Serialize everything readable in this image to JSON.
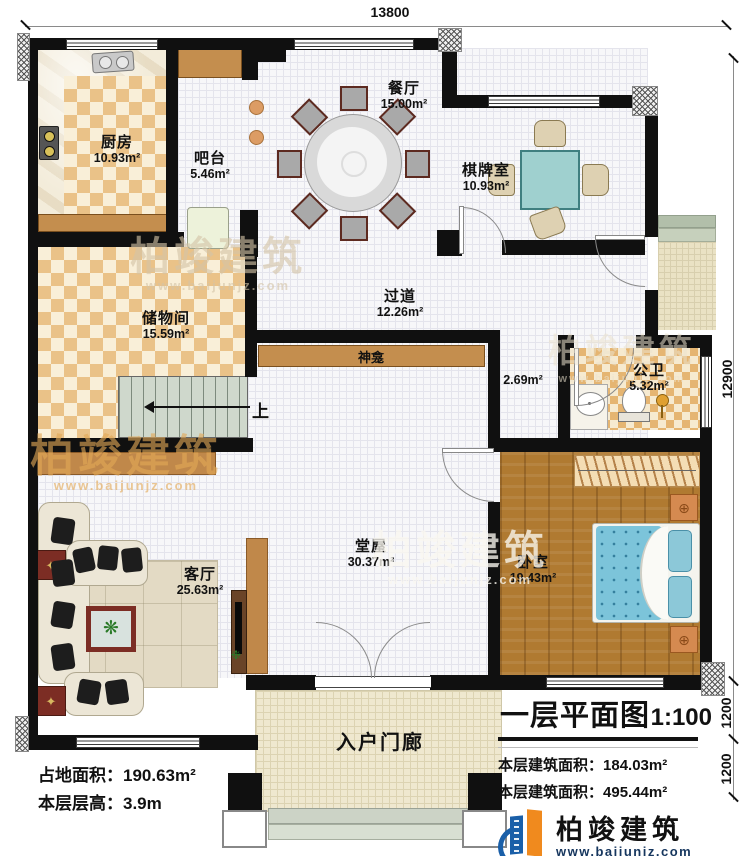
{
  "dimensions": {
    "top": "13800",
    "right_main": "12900",
    "right_upper": "1200",
    "right_lower": "1200"
  },
  "rooms": {
    "kitchen": {
      "name": "厨房",
      "area": "10.93m²"
    },
    "bar": {
      "name": "吧台",
      "area": "5.46m²"
    },
    "dining": {
      "name": "餐厅",
      "area": "15.00m²"
    },
    "chess": {
      "name": "棋牌室",
      "area": "10.93m²"
    },
    "storage": {
      "name": "储物间",
      "area": "15.59m²"
    },
    "corridor": {
      "name": "过道",
      "area": "12.26m²"
    },
    "shrine": {
      "name": "神龛",
      "area": "2.69m²"
    },
    "bathroom": {
      "name": "公卫",
      "area": "5.32m²"
    },
    "hall": {
      "name": "堂屋",
      "area": "30.37m²"
    },
    "living": {
      "name": "客厅",
      "area": "25.63m²"
    },
    "bedroom": {
      "name": "卧室",
      "area": "19.43m²"
    },
    "porch": {
      "name": "入户门廊"
    }
  },
  "stairs": {
    "up_label": "上"
  },
  "info_left": {
    "line1_label": "占地面积：",
    "line1_value": "190.63m²",
    "line2_label": "本层层高：",
    "line2_value": "3.9m"
  },
  "title_block": {
    "title": "一层平面图",
    "scale": "1:100",
    "area1_label": "本层建筑面积：",
    "area1_value": "184.03m²",
    "area2_label": "本层建筑面积：",
    "area2_value": "495.44m²"
  },
  "brand": {
    "name": "柏竣建筑",
    "url": "www.baijunjz.com"
  },
  "watermark": {
    "text": "柏竣建筑",
    "url": "www.baijunjz.com"
  },
  "colors": {
    "wall": "#101010",
    "checker_tan": "#eac288",
    "wood": "#b07a31",
    "bed_teal": "#7cc4da",
    "brand_blue": "#1a5fa8",
    "brand_orange": "#f08a1e"
  }
}
